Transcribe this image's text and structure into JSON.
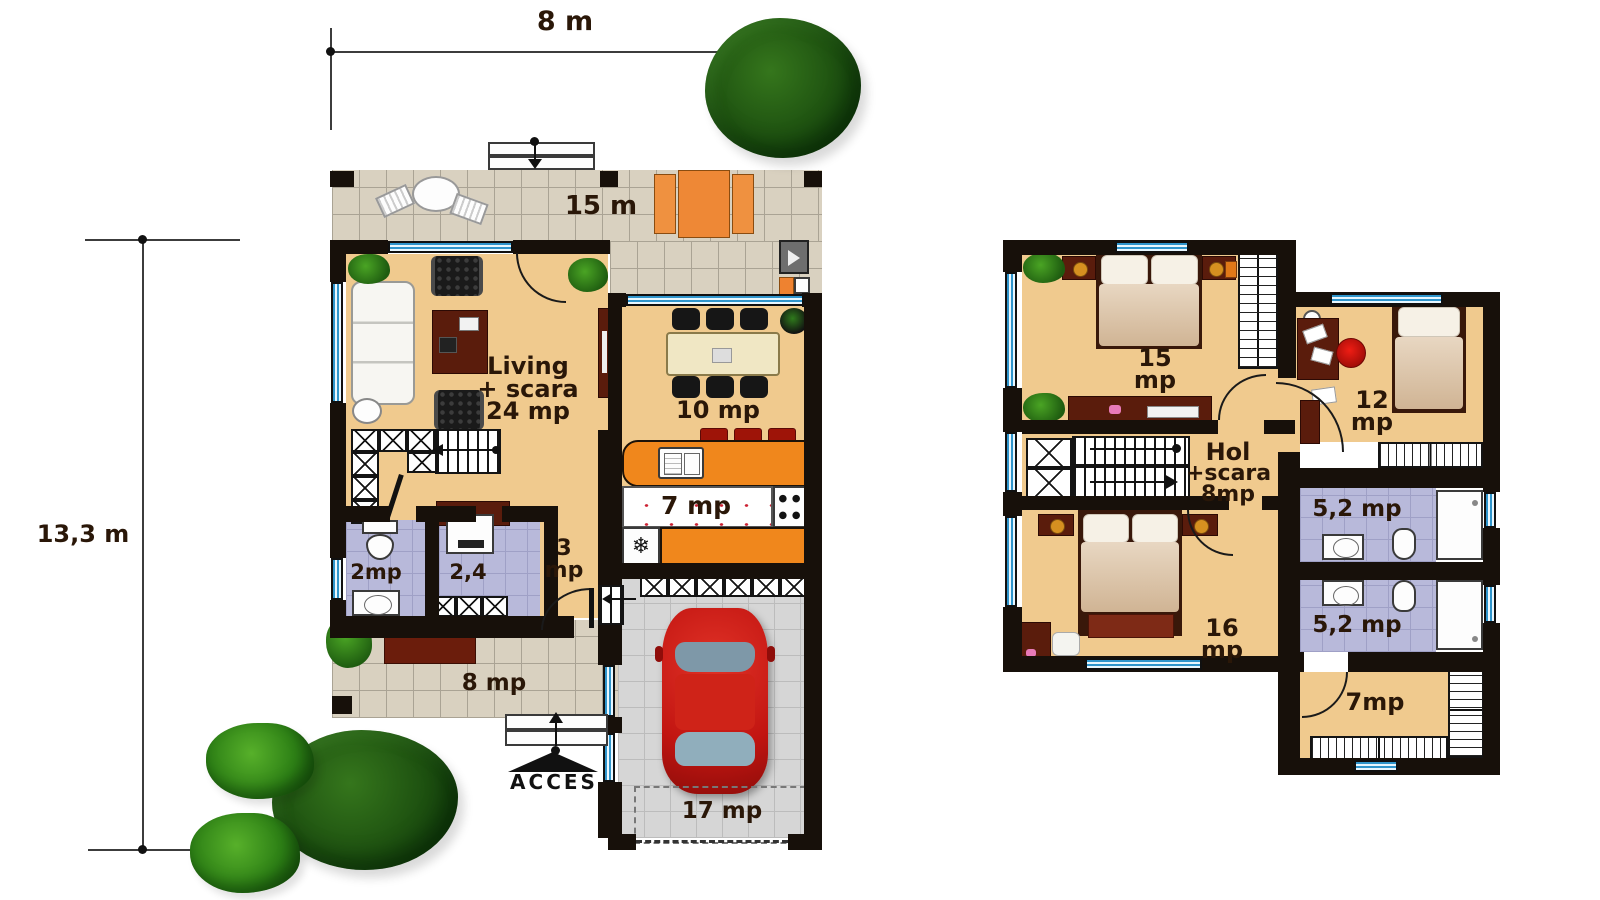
{
  "dimensions": {
    "width_label": "8 m",
    "height_label": "13,3 m"
  },
  "ground_floor": {
    "terrace_top_label": "15 m",
    "living_label": [
      "Living",
      "+ scara",
      "24 mp"
    ],
    "dining_label": "10 mp",
    "kitchen_label": "7 mp",
    "hall_label": [
      "3",
      "mp"
    ],
    "bath_label": "2mp",
    "wc_label": "2,4",
    "terrace_bottom_label": "8 mp",
    "garage_label": "17 mp",
    "access_label": "ACCES"
  },
  "upper_floor": {
    "bedroom1_label": [
      "15",
      "mp"
    ],
    "office_label": [
      "12",
      "mp"
    ],
    "hall_label": [
      "Hol",
      "+scara",
      "8mp"
    ],
    "bath_top_label": "5,2 mp",
    "bath_bottom_label": "5,2 mp",
    "bedroom2_label": [
      "16",
      "mp"
    ],
    "dressing_label": "7mp"
  },
  "icons": {
    "freezer": "❄"
  },
  "colors": {
    "wall": "#17100a",
    "wood": "#f0ca8e",
    "tile": "#d9d1c0",
    "tile-line": "#aaa394",
    "garage": "#d6d6d6",
    "garage-line": "#bcbcbc",
    "bath": "#b8b9da",
    "bath-line": "#9fa0c6",
    "win-blue": "#2f95cc",
    "win-light": "#e8f7ff",
    "orange": "#f0871c",
    "furn": "#5a1c0c",
    "car": "#c21511",
    "text": "#2a1708",
    "tree-dark": "#1d5010",
    "tree-bright": "#2e8116"
  }
}
